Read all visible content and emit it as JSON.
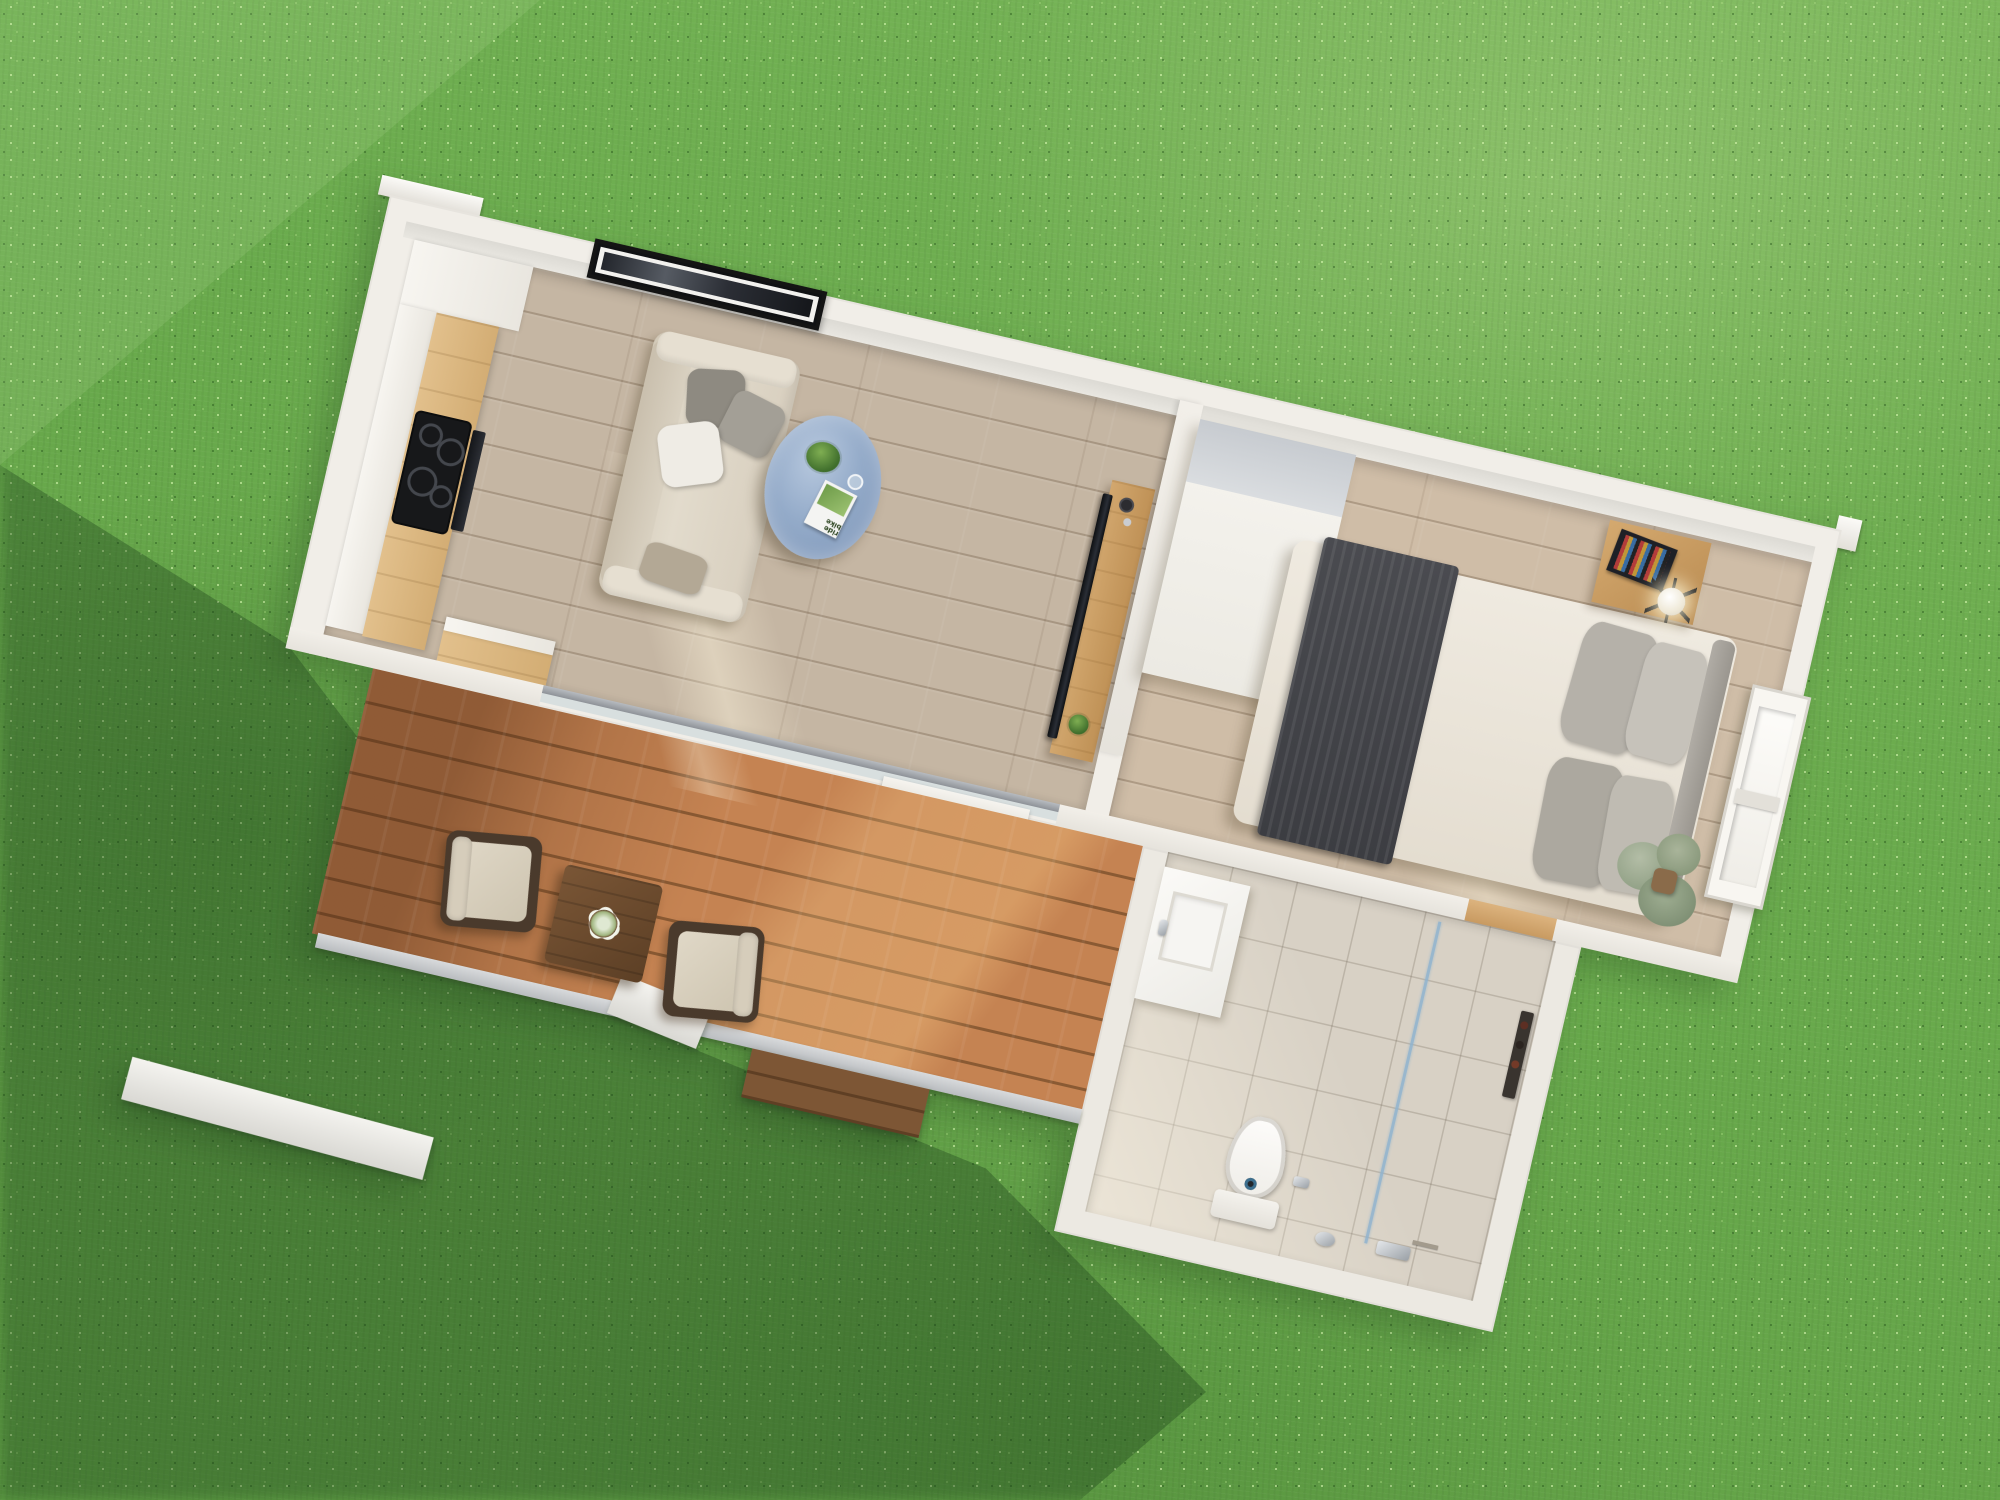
{
  "scene": {
    "type": "3d-aerial-floor-plan-render",
    "subject": "tiny house with deck viewed from directly above on a green lawn",
    "rotation_deg": 13,
    "lighting": "sun from upper right, soft shadow cast to lower left"
  },
  "palette": {
    "grass": "#67a74b",
    "grass_light": "#85c263",
    "cast_shadow": "rgba(24,60,22,0.34)",
    "wall": "#f1eee8",
    "wall_inner": "#dcdad4",
    "floor_wood": "#c5b6a3",
    "floor_bedroom": "#cfbda7",
    "deck_wood": "#c07c4a",
    "bath_tile": "#d8d1c5",
    "counter_oak": "#d9b67e",
    "cooktop": "#17181a",
    "sofa": "#ddd5c6",
    "coffee_table_marble": "#8aa3c4",
    "media_console": "#c89a61",
    "tv": "#181c22",
    "wardrobe": "#f4f2ec",
    "bed_duvet": "#ebe6dc",
    "bed_throw": "#46474c",
    "pillow_gray": "#b5b1a9",
    "headboard": "#a5a19a",
    "nightstand": "#c79e66",
    "toilet": "#fbfaf7",
    "shower_glass": "#8fb3cf",
    "outdoor_table": "#6b4a2e",
    "armchair_frame": "#4a3a2c",
    "armchair_cushion": "#d9d1c0"
  },
  "house": {
    "rooms": [
      {
        "id": "kitchen",
        "label": "Kitchen",
        "features": [
          "tall white cabinet",
          "white cabinet run",
          "oak countertop",
          "black induction cooktop with 4 burners",
          "built-in oven",
          "oak base cabinet"
        ]
      },
      {
        "id": "living-room",
        "label": "Living room",
        "features": [
          "panoramic framed wall art",
          "cream fabric sofa",
          "two gray pillows",
          "white pillow",
          "taupe pillow",
          "oval blue marble coffee table",
          "potted plant",
          "magazine",
          "drinking glass",
          "oak media console",
          "flat TV panel",
          "console plant",
          "sliding glass door"
        ]
      },
      {
        "id": "bedroom",
        "label": "Bedroom",
        "features": [
          "white wardrobe column",
          "double bed",
          "dark gray throw blanket",
          "cream duvet",
          "four gray pillows",
          "padded headboard",
          "oak nightstand",
          "globe table lamp",
          "open book",
          "side window",
          "eucalyptus plant in pot"
        ]
      },
      {
        "id": "bathroom",
        "label": "Bathroom",
        "features": [
          "white vanity with rectangular basin",
          "toilet",
          "glass shower screen",
          "chrome shower mixer",
          "hand shower",
          "dark towel rack with toiletries",
          "floor drain",
          "wood door threshold"
        ]
      },
      {
        "id": "deck",
        "label": "Wooden deck",
        "features": [
          "two wicker armchairs with cream cushions",
          "square dark wood table",
          "white flower centerpiece",
          "walnut front step",
          "white edge beams"
        ]
      }
    ]
  },
  "decor": {
    "magazine_title": "ride bike"
  }
}
